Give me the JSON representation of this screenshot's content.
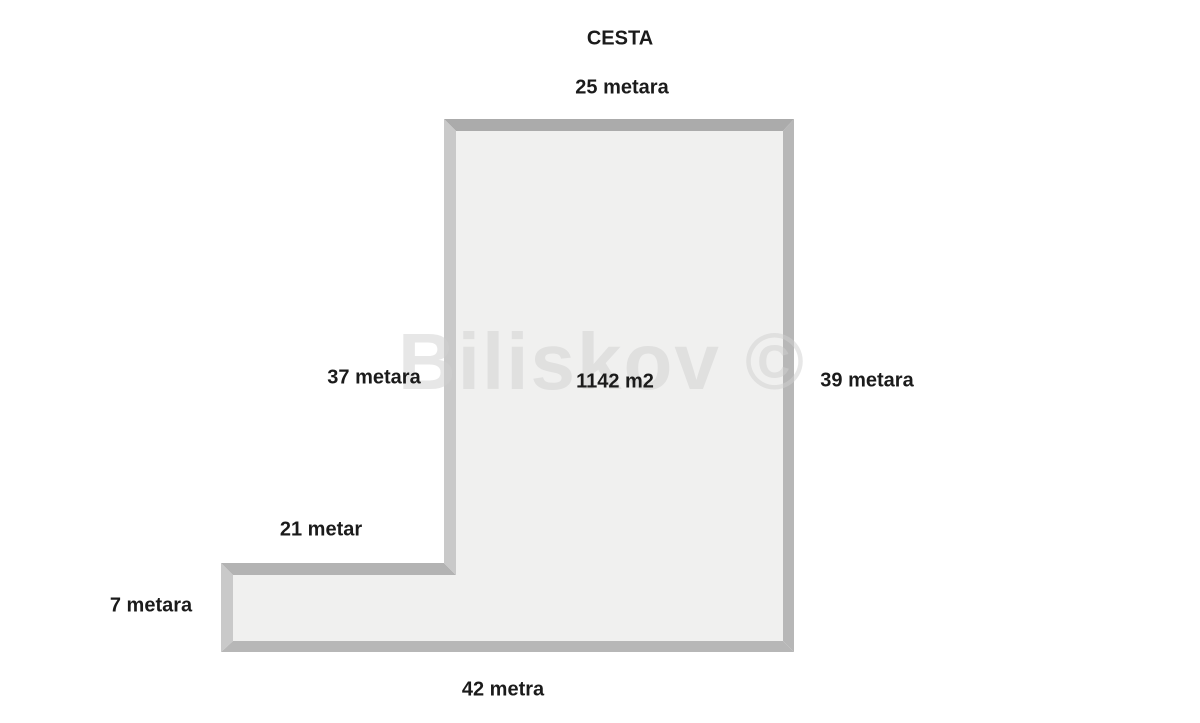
{
  "diagram": {
    "road_label": "CESTA",
    "area_label": "1142 m2",
    "watermark": "Biliskov ©",
    "dimensions": {
      "top": "25 metara",
      "left_upper": "37 metara",
      "right": "39 metara",
      "step": "21 metar",
      "left_lower": "7 metara",
      "bottom": "42 metra"
    },
    "colors": {
      "background": "#ffffff",
      "parcel_fill": "#f0f0ef",
      "border_top": "#ababab",
      "border_right": "#b7b7b7",
      "border_bottom": "#b7b7b7",
      "border_step": "#b3b3b3",
      "border_left_upper": "#c9c9c9",
      "border_left_lower": "#c9c9c9",
      "label_text": "#1b1b1b",
      "watermark_text": "#cfcfcf"
    }
  }
}
